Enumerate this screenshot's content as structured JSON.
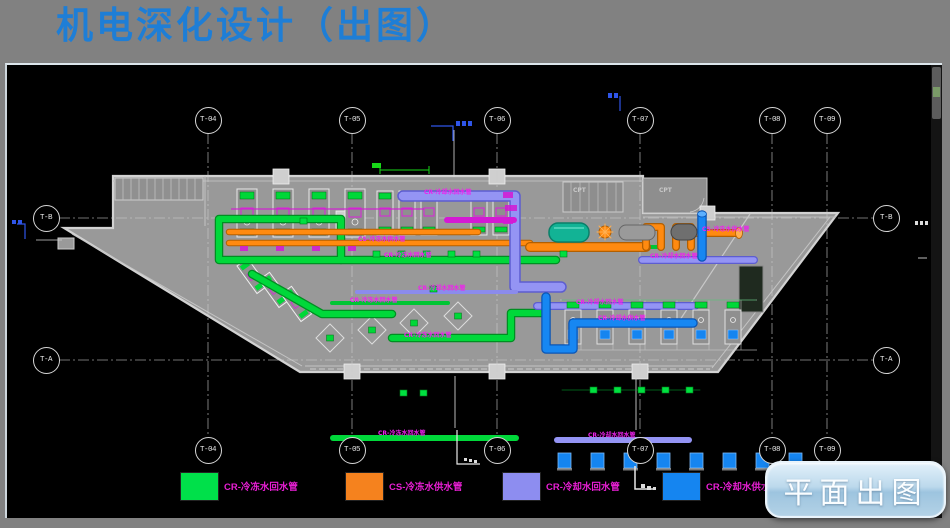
{
  "title": "机电深化设计（出图）",
  "button": {
    "label": "平面出图"
  },
  "colors": {
    "title_blue": "#1e7ed6",
    "chilled_return_green": "#00e04a",
    "chilled_supply_orange": "#f5821e",
    "cooling_return_lavender": "#8d8df0",
    "cooling_supply_blue": "#1585f0",
    "label_magenta": "#e81fd4"
  },
  "grid_bubbles": {
    "top": [
      {
        "label": "T-04",
        "x": 208,
        "y": 120
      },
      {
        "label": "T-05",
        "x": 352,
        "y": 120
      },
      {
        "label": "T-06",
        "x": 497,
        "y": 120
      },
      {
        "label": "T-07",
        "x": 640,
        "y": 120
      },
      {
        "label": "T-08",
        "x": 772,
        "y": 120
      },
      {
        "label": "T-09",
        "x": 827,
        "y": 120
      }
    ],
    "bottom": [
      {
        "label": "T-04",
        "x": 208,
        "y": 450
      },
      {
        "label": "T-05",
        "x": 352,
        "y": 450
      },
      {
        "label": "T-06",
        "x": 497,
        "y": 450
      },
      {
        "label": "T-07",
        "x": 640,
        "y": 450
      },
      {
        "label": "T-08",
        "x": 772,
        "y": 450
      },
      {
        "label": "T-09",
        "x": 827,
        "y": 450
      }
    ],
    "left": [
      {
        "label": "T-B",
        "x": 46,
        "y": 218
      },
      {
        "label": "T-A",
        "x": 46,
        "y": 360
      }
    ],
    "right": [
      {
        "label": "T-B",
        "x": 886,
        "y": 218
      },
      {
        "label": "T-A",
        "x": 886,
        "y": 360
      }
    ]
  },
  "legend": [
    {
      "label": "CR-冷冻水回水管",
      "color": "#00e04a",
      "x": 180
    },
    {
      "label": "CS-冷冻水供水管",
      "color": "#f5821e",
      "x": 345
    },
    {
      "label": "CR-冷却水回水管",
      "color": "#8d8df0",
      "x": 502
    },
    {
      "label": "CR-冷却水供水管",
      "color": "#1585f0",
      "x": 662
    }
  ],
  "pipe_labels": [
    {
      "text": "CR-冷却水回水管",
      "color": "#ee22ee",
      "x": 424,
      "y": 190
    },
    {
      "text": "CS-冷冻水供水管",
      "color": "#ee22ee",
      "x": 358,
      "y": 237
    },
    {
      "text": "CS-冷冻水供水管",
      "color": "#ee22ee",
      "x": 702,
      "y": 227
    },
    {
      "text": "CR-冷冻水回水管",
      "color": "#ee22ee",
      "x": 384,
      "y": 253
    },
    {
      "text": "CR-冷冻水回水管",
      "color": "#ee22ee",
      "x": 350,
      "y": 298
    },
    {
      "text": "CR-冷冻水回水管",
      "color": "#ee22ee",
      "x": 404,
      "y": 333
    },
    {
      "text": "CR-冷却水回水管",
      "color": "#ee22ee",
      "x": 418,
      "y": 286
    },
    {
      "text": "CR-冷却水回水管",
      "color": "#ee22ee",
      "x": 576,
      "y": 300
    },
    {
      "text": "CR-冷却水供水管",
      "color": "#ee22ee",
      "x": 598,
      "y": 316
    },
    {
      "text": "CR-冷却水回水管",
      "color": "#ee22ee",
      "x": 650,
      "y": 254
    },
    {
      "text": "CR-冷冻水回水管",
      "color": "#ee22ee",
      "x": 378,
      "y": 431
    },
    {
      "text": "CR-冷却水回水管",
      "color": "#ee22ee",
      "x": 588,
      "y": 433
    },
    {
      "text": "CPT",
      "color": "#c8c8c8",
      "x": 573,
      "y": 190
    },
    {
      "text": "CPT",
      "color": "#c8c8c8",
      "x": 659,
      "y": 190
    }
  ]
}
